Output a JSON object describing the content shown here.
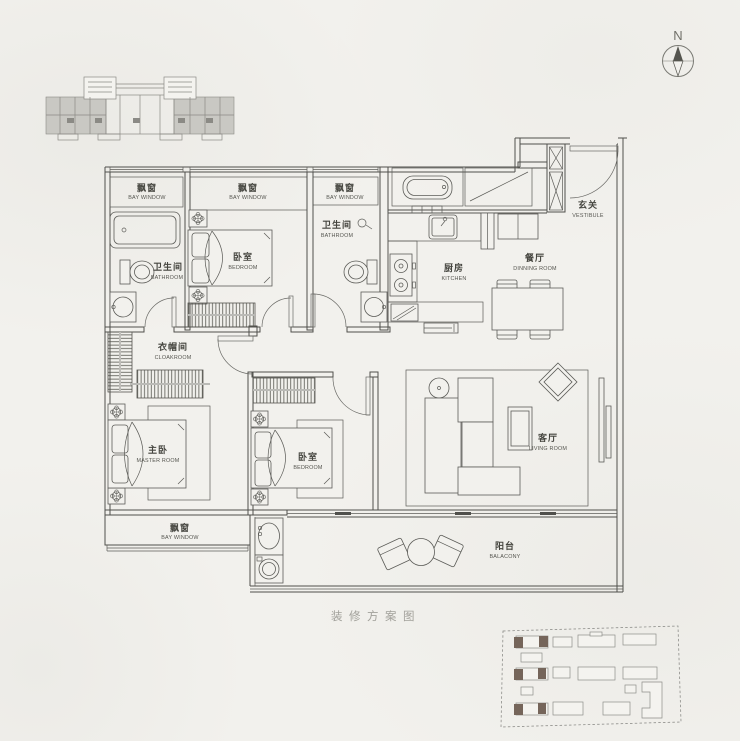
{
  "page": {
    "caption": "装修方案图"
  },
  "compass": {
    "north_label": "N"
  },
  "colors": {
    "background": "#f2f1ed",
    "line": "#50504c",
    "label": "#45453f",
    "muted_caption": "#a2a19b",
    "keyplan_shade": "#c9c8c3",
    "siteplan_highlight": "#75655a"
  },
  "rooms": {
    "bay_window": {
      "zh": "飘窗",
      "en": "BAY WINDOW"
    },
    "bathroom": {
      "zh": "卫生间",
      "en": "BATHROOM"
    },
    "bedroom": {
      "zh": "卧室",
      "en": "BEDROOM"
    },
    "master_room": {
      "zh": "主卧",
      "en": "MASTER ROOM"
    },
    "cloakroom": {
      "zh": "衣帽间",
      "en": "CLOAKROOM"
    },
    "kitchen": {
      "zh": "厨房",
      "en": "KITCHEN"
    },
    "dining_room": {
      "zh": "餐厅",
      "en": "DINNING ROOM"
    },
    "vestibule": {
      "zh": "玄关",
      "en": "VESTIBULE"
    },
    "living_room": {
      "zh": "客厅",
      "en": "LIVING ROOM"
    },
    "balcony": {
      "zh": "阳台",
      "en": "BALACONY"
    }
  }
}
